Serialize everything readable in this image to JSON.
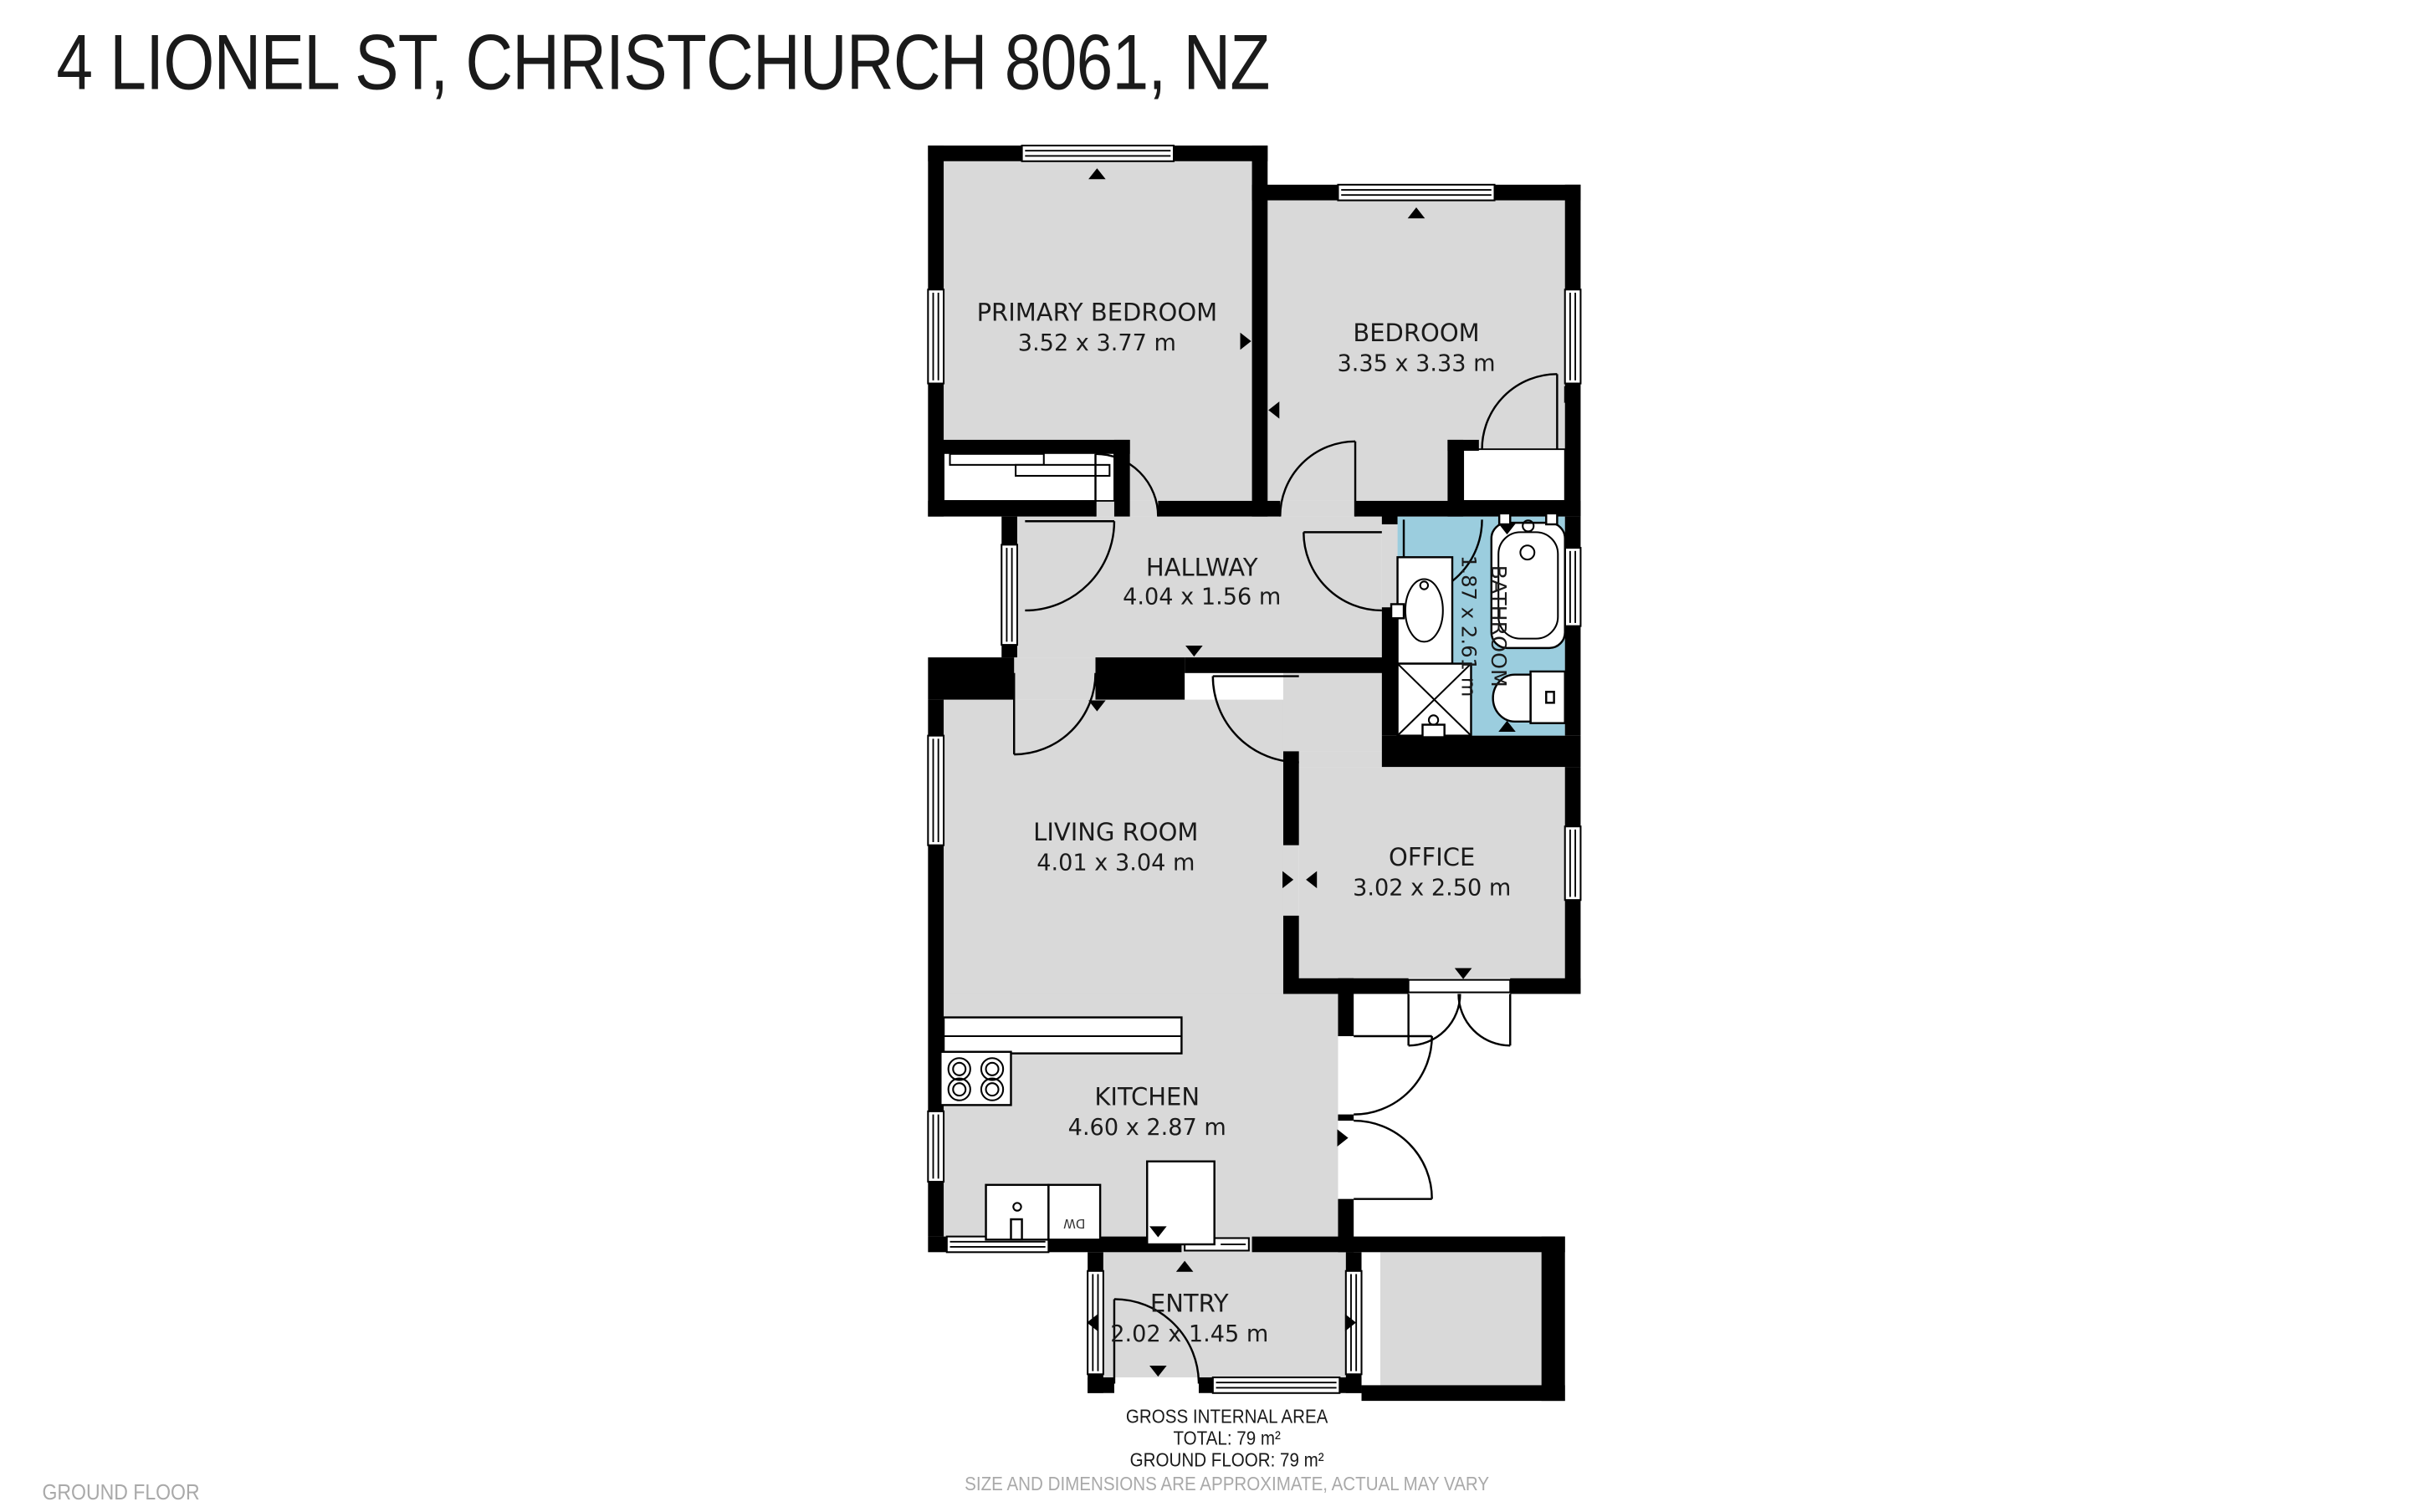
{
  "title": "4 LIONEL ST, CHRISTCHURCH 8061, NZ",
  "floor_label": "GROUND FLOOR",
  "rooms": {
    "primary_bedroom": {
      "name": "PRIMARY BEDROOM",
      "dims": "3.52 x 3.77 m"
    },
    "bedroom": {
      "name": "BEDROOM",
      "dims": "3.35 x 3.33 m"
    },
    "hallway": {
      "name": "HALLWAY",
      "dims": "4.04 x 1.56 m"
    },
    "bathroom": {
      "name": "BATHROOM",
      "dims": "1.87 x 2.61 m"
    },
    "living_room": {
      "name": "LIVING ROOM",
      "dims": "4.01 x 3.04 m"
    },
    "office": {
      "name": "OFFICE",
      "dims": "3.02 x 2.50 m"
    },
    "kitchen": {
      "name": "KITCHEN",
      "dims": "4.60 x 2.87 m"
    },
    "entry": {
      "name": "ENTRY",
      "dims": "2.02 x 1.45 m"
    }
  },
  "fixtures": {
    "dishwasher_label": "DW"
  },
  "footer": {
    "line1": "GROSS INTERNAL AREA",
    "line2": "TOTAL: 79 m²",
    "line3": "GROUND FLOOR: 79 m²",
    "disclaimer": "SIZE AND DIMENSIONS ARE APPROXIMATE, ACTUAL MAY VARY"
  },
  "colors": {
    "wall": "#000000",
    "room_fill": "#D9D9D9",
    "bathroom_fill": "#9BCDDE",
    "muted_text": "#A9A9A9",
    "label_text": "#1A1A1A"
  }
}
